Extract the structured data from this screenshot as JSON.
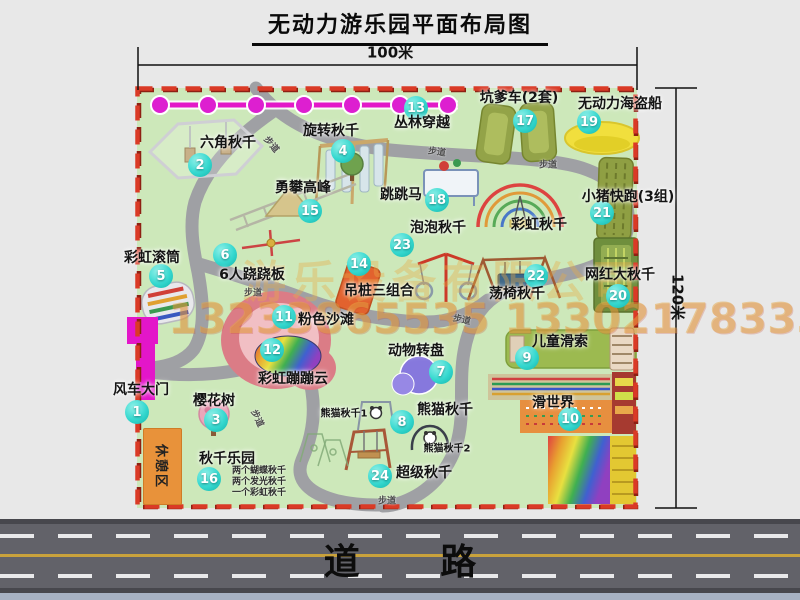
{
  "title": "无动力游乐园平面布局图",
  "dim_width": "100米",
  "dim_height": "120米",
  "road_label": "道 路",
  "trail_label": "步道",
  "rest_area_label": "休憩区",
  "watermark": {
    "company": "游乐设备有限公司",
    "phone": "13233865535 13302178333"
  },
  "colors": {
    "marker": "#35d8cf",
    "boundary_red": "#da3a26",
    "map_green": "#cde8ba",
    "gate_magenta": "#e316c9",
    "jungle_line_magenta": "#e318c8",
    "road_gray": "#626269"
  },
  "attractions": {
    "windmill_gate": {
      "num": "1",
      "label": "风车大门"
    },
    "hex_swing": {
      "num": "2",
      "label": "六角秋千"
    },
    "sakura_tree": {
      "num": "3",
      "label": "樱花树"
    },
    "rotary_swing": {
      "num": "4",
      "label": "旋转秋千"
    },
    "rainbow_roller": {
      "num": "5",
      "label": "彩虹滚筒"
    },
    "seesaw_6p": {
      "num": "6",
      "label": "6人跷跷板"
    },
    "animal_carousel": {
      "num": "7",
      "label": "动物转盘"
    },
    "panda_swing": {
      "num": "8",
      "label": "熊猫秋千",
      "sub1": "熊猫秋千1",
      "sub2": "熊猫秋千2"
    },
    "kids_zipline": {
      "num": "9",
      "label": "儿童滑索"
    },
    "slide_world": {
      "num": "10",
      "label": "滑世界"
    },
    "pink_beach": {
      "num": "11",
      "label": "粉色沙滩"
    },
    "rainbow_cloud": {
      "num": "12",
      "label": "彩虹蹦蹦云"
    },
    "jungle_crossing": {
      "num": "13",
      "label": "丛林穿越"
    },
    "post_combo": {
      "num": "14",
      "label": "吊桩三组合"
    },
    "climbing_peak": {
      "num": "15",
      "label": "勇攀高峰"
    },
    "swing_paradise": {
      "num": "16",
      "label": "秋千乐园",
      "notes": [
        "两个蝴蝶秋千",
        "两个发光秋千",
        "一个彩虹秋千"
      ]
    },
    "pit_kart": {
      "num": "17",
      "label": "坑爹车(2套)"
    },
    "jumping_horse": {
      "num": "18",
      "label": "跳跳马"
    },
    "pirate_ship": {
      "num": "19",
      "label": "无动力海盗船"
    },
    "viral_big_swing": {
      "num": "20",
      "label": "网红大秋千"
    },
    "piggy_run": {
      "num": "21",
      "label": "小猪快跑(3组)"
    },
    "chair_swing": {
      "num": "22",
      "label": "荡椅秋千"
    },
    "bubble_swing": {
      "num": "23",
      "label": "泡泡秋千"
    },
    "super_swing": {
      "num": "24",
      "label": "超级秋千"
    },
    "rainbow_swing": {
      "label": "彩虹秋千"
    }
  }
}
